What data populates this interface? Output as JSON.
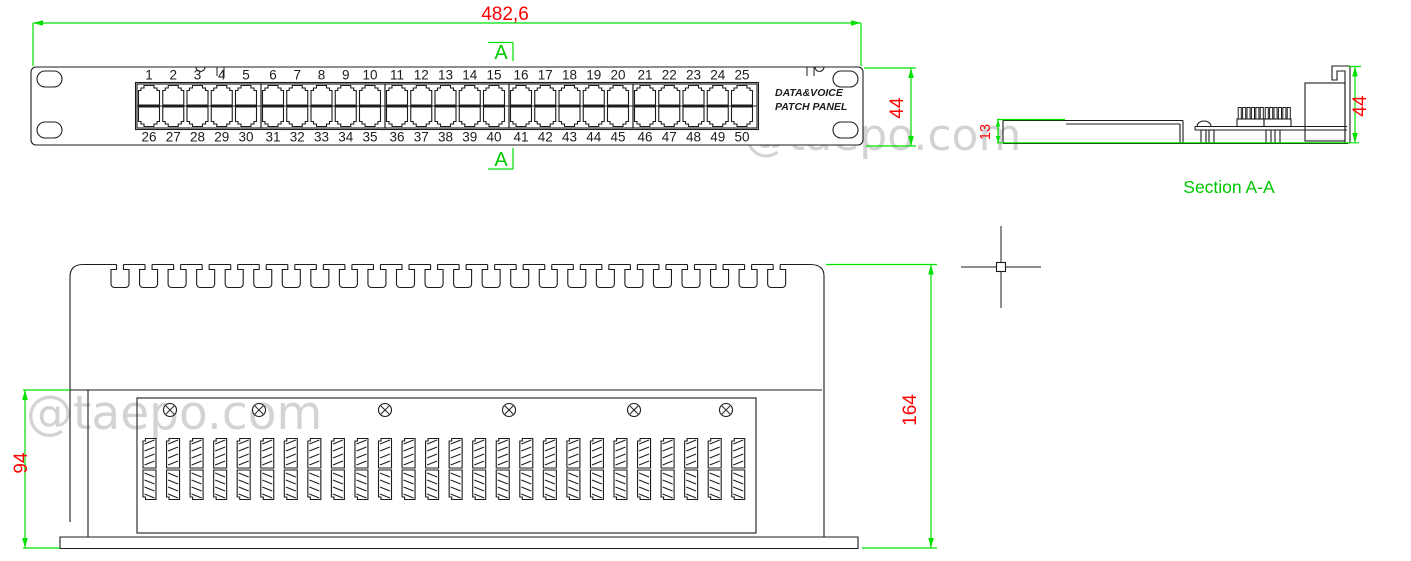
{
  "watermark": {
    "text": "@taepo.com",
    "color": "#c9c9c9"
  },
  "colors": {
    "dimension_line": "#00e100",
    "dimension_text": "#ff0000",
    "drawing_outline": "#1c1c1c",
    "background": "#ffffff"
  },
  "front_view": {
    "width_dim": "482,6",
    "height_dim": "44",
    "section_mark_top": "A",
    "section_mark_bottom": "A",
    "panel_label_line1": "DATA&VOICE",
    "panel_label_line2": "PATCH PANEL",
    "port_numbers_top": [
      "1",
      "2",
      "3",
      "4",
      "5",
      "6",
      "7",
      "8",
      "9",
      "10",
      "11",
      "12",
      "13",
      "14",
      "15",
      "16",
      "17",
      "18",
      "19",
      "20",
      "21",
      "22",
      "23",
      "24",
      "25"
    ],
    "port_numbers_bottom": [
      "26",
      "27",
      "28",
      "29",
      "30",
      "31",
      "32",
      "33",
      "34",
      "35",
      "36",
      "37",
      "38",
      "39",
      "40",
      "41",
      "42",
      "43",
      "44",
      "45",
      "46",
      "47",
      "48",
      "49",
      "50"
    ]
  },
  "section_view": {
    "label": "Section A-A",
    "height_dim": "44",
    "tray_dim": "13"
  },
  "rear_view": {
    "height_dim": "94",
    "overall_dim": "164"
  }
}
